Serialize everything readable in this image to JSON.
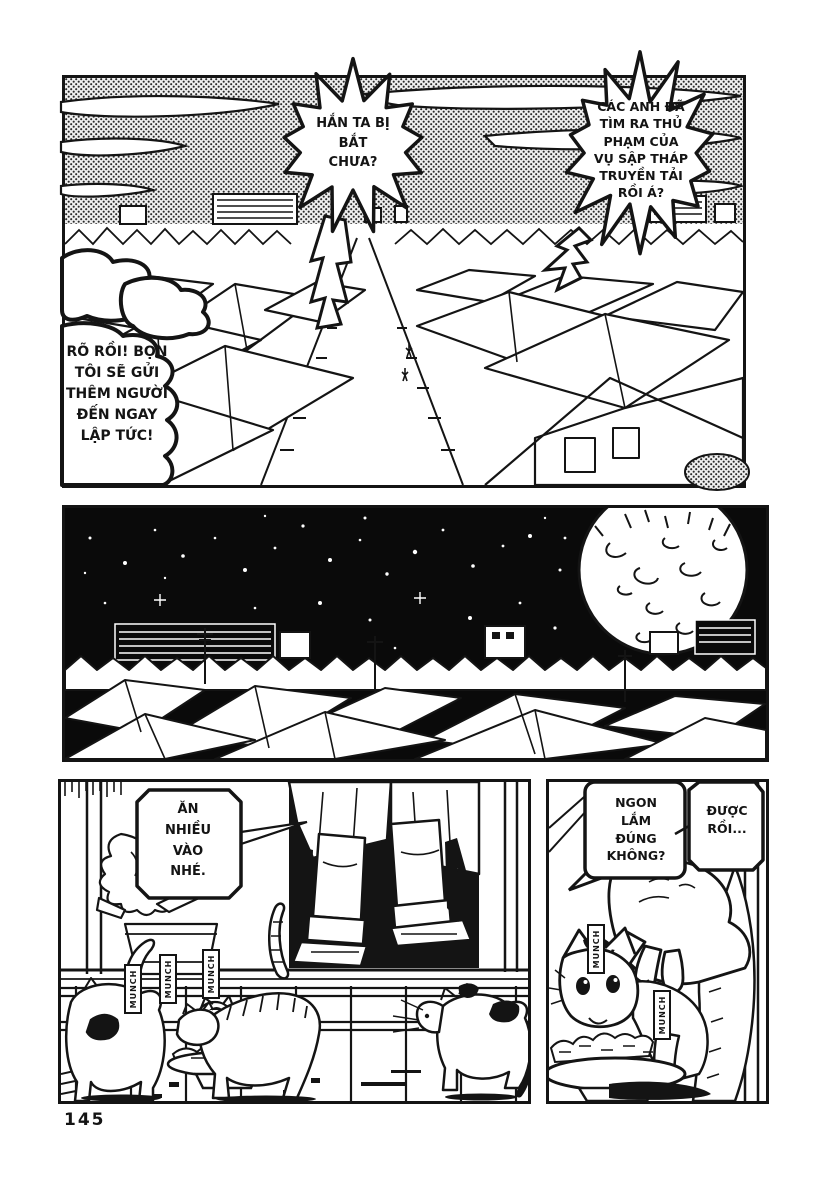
{
  "page": {
    "number": "145"
  },
  "colors": {
    "ink": "#141414",
    "paper": "#ffffff",
    "sky_halftone_gray": "#8f8f8f",
    "night_sky": "#0a0a0a"
  },
  "panel_day": {
    "bubble_question_left": [
      "HẮN TA BỊ",
      "BẮT",
      "CHƯA?"
    ],
    "bubble_question_right": [
      "CÁC ANH ĐÃ",
      "TÌM RA THỦ",
      "PHẠM CỦA",
      "VỤ SẬP THÁP",
      "TRUYỀN TẢI",
      "RỒI Á?"
    ],
    "bubble_reply": [
      "RÕ RỒI! BỌN",
      "TÔI SẼ GỬI",
      "THÊM NGƯỜI",
      "ĐẾN NGAY",
      "LẬP TỨC!"
    ]
  },
  "panel_porch": {
    "bubble_feed": [
      "ĂN",
      "NHIỀU",
      "VÀO",
      "NHÉ."
    ],
    "sfx": [
      "MUNCH",
      "MUNCH",
      "MUNCH"
    ]
  },
  "panel_hand": {
    "bubble_tasty": [
      "NGON",
      "LẮM",
      "ĐÚNG",
      "KHÔNG?"
    ],
    "bubble_reply": [
      "ĐƯỢC",
      "RỒI..."
    ],
    "sfx": [
      "MUNCH",
      "MUNCH"
    ]
  }
}
